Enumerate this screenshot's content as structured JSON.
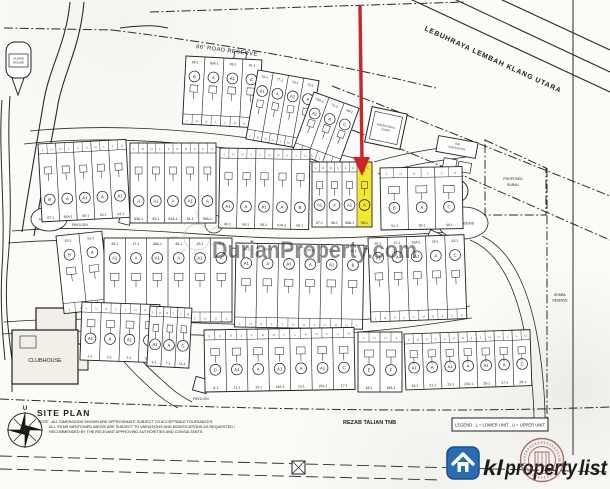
{
  "map": {
    "highway_label": "LEBUHRAYA LEMBAH KLANG UTARA",
    "road_reserve_label": "66' ROAD RESERVE",
    "guard_house_line1": "GUARD",
    "guard_house_line2": "HOUSE",
    "pavilion_label": "PAVILION",
    "playground_label": "PLAYGROUND",
    "par_course_label": "PAR COURSE",
    "basketball_line1": "B.BASKETBALL",
    "basketball_line2": "COURT",
    "tnb_line1": "TNB",
    "tnb_line2": "SUB-STATION",
    "pump_house_label": "PUMP HOUSE",
    "water_tank_line1": "ELEVATED",
    "water_tank_line2": "WATER",
    "water_tank_line3": "TANK",
    "surau_line1": "PROPOSED",
    "surau_line2": "SURAU",
    "bomba_line1": "BOMBA",
    "bomba_line2": "RESERVE",
    "clubhouse_label": "CLUBHOUSE",
    "rezab_label": "REZAB TALIAN TNB",
    "legend_label": "LEGEND : L = LOWER UNIT , U = UPPER UNIT",
    "north_label": "U"
  },
  "titleblock": {
    "title": "SITE PLAN",
    "note1": "NOTE : ALL DIMENSIONS SHOWN ARE APPROXIMATE SUBJECT TO ACCEPTABLE TOLERANCES.",
    "note2": "ALL ITEMS MENTIONED ABOVE ARE SUBJECT TO VARIATIONS AND MODIFICATIONS AS REQUESTED /",
    "note3": "RECOMMENDED BY THE RELEVANT APPROVING AUTHORITIES AND CONSULTANTS."
  },
  "watermark": {
    "text": "DurianProperty.com"
  },
  "logo": {
    "kl": "kl",
    "property": "property",
    "list": "list"
  },
  "highlight": {
    "unit_fill": "#f4e72e",
    "arrow_color": "#c9252b"
  },
  "lot_rows": [
    {
      "id": "r1a",
      "x": 186,
      "y": 56,
      "angle": 3,
      "w": 76,
      "h": 68,
      "n": 4,
      "pos": "top",
      "letters": [
        "B",
        "A",
        "A1",
        "A"
      ],
      "numbers": [
        "85-1",
        "83A-1",
        "83-1",
        "81-1"
      ]
    },
    {
      "id": "r1b",
      "x": 258,
      "y": 70,
      "angle": 10,
      "w": 62,
      "h": 70,
      "n": 4,
      "pos": "top",
      "letters": [
        "A1",
        "A",
        "A1",
        "A"
      ],
      "numbers": [
        "79-1",
        "77-1",
        "75-1",
        "73-1"
      ]
    },
    {
      "id": "r1c",
      "x": 314,
      "y": 92,
      "angle": 20,
      "w": 48,
      "h": 64,
      "n": 3,
      "pos": "top",
      "letters": [
        "A1",
        "A",
        "C"
      ],
      "numbers": [
        "73A-1",
        "71-1",
        "69-1"
      ]
    },
    {
      "id": "r2a",
      "x": 38,
      "y": 144,
      "angle": -3,
      "w": 88,
      "h": 78,
      "n": 5,
      "pos": "bottom",
      "letters": [
        "B",
        "A",
        "A1",
        "A",
        "A1"
      ],
      "numbers": [
        "67-1",
        "65A-1",
        "65-1",
        "63-1",
        "61-1"
      ]
    },
    {
      "id": "r2b",
      "x": 130,
      "y": 143,
      "angle": 0,
      "w": 86,
      "h": 80,
      "n": 5,
      "pos": "bottom",
      "letters": [
        "A",
        "A1",
        "A",
        "A1",
        "A"
      ],
      "numbers": [
        "63A-1",
        "63-1",
        "61A-1",
        "61-1",
        "59A-1"
      ]
    },
    {
      "id": "r2c",
      "x": 220,
      "y": 148,
      "angle": 1,
      "w": 90,
      "h": 80,
      "n": 5,
      "pos": "bottom",
      "letters": [
        "A1",
        "A",
        "A1",
        "A",
        "B"
      ],
      "numbers": [
        "60-1",
        "59-1",
        "58-1",
        "57A-1",
        "56-1"
      ]
    },
    {
      "id": "r2d",
      "x": 312,
      "y": 162,
      "angle": 0,
      "w": 60,
      "h": 65,
      "n": 4,
      "pos": "bottom",
      "letters": [
        "A1",
        "A",
        "A1",
        "A"
      ],
      "numbers": [
        "57-1",
        "56-1",
        "55A-1",
        "55-1"
      ],
      "highlight": 3
    },
    {
      "id": "r2e",
      "x": 380,
      "y": 168,
      "angle": -1,
      "w": 82,
      "h": 62,
      "n": 3,
      "pos": "bottom",
      "letters": [
        "B",
        "A",
        "C"
      ],
      "numbers": [
        "51-1",
        "50-1",
        "49-1"
      ]
    },
    {
      "id": "r3a",
      "x": 56,
      "y": 236,
      "angle": -6,
      "w": 46,
      "h": 78,
      "n": 2,
      "pos": "top",
      "letters": [
        "B",
        "A"
      ],
      "numbers": [
        "53-1",
        "51-1"
      ]
    },
    {
      "id": "r3b",
      "x": 104,
      "y": 238,
      "angle": 0,
      "w": 128,
      "h": 84,
      "n": 6,
      "pos": "top",
      "letters": [
        "A1",
        "A",
        "A1",
        "A",
        "A1",
        "A"
      ],
      "numbers": [
        "49-1",
        "47-1",
        "45A-1",
        "45-1",
        "43-1",
        "41-1"
      ]
    },
    {
      "id": "r3c",
      "x": 236,
      "y": 243,
      "angle": 1,
      "w": 128,
      "h": 84,
      "n": 6,
      "pos": "top",
      "letters": [
        "A1",
        "A",
        "A1",
        "A",
        "A1",
        "B"
      ],
      "numbers": [
        "39-1",
        "37A-1",
        "37-1",
        "35-1",
        "33-1",
        "31-1"
      ]
    },
    {
      "id": "r3d",
      "x": 368,
      "y": 238,
      "angle": -2,
      "w": 96,
      "h": 84,
      "n": 5,
      "pos": "top",
      "letters": [
        "A1",
        "A",
        "A1",
        "A",
        "C"
      ],
      "numbers": [
        "29-1",
        "27-1",
        "25A-1",
        "25-1",
        "23-1"
      ]
    },
    {
      "id": "r4a",
      "x": 82,
      "y": 302,
      "angle": 2,
      "w": 78,
      "h": 58,
      "n": 4,
      "pos": "bottom",
      "letters": [
        "A1",
        "A",
        "A1",
        "A"
      ],
      "numbers": [
        "1-1",
        "2-1",
        "3-1",
        "3A-1"
      ]
    },
    {
      "id": "r4a2",
      "x": 150,
      "y": 306,
      "angle": 3,
      "w": 42,
      "h": 60,
      "n": 3,
      "pos": "bottom",
      "letters": [
        "A1",
        "A",
        "C"
      ],
      "numbers": [
        "5-1",
        "7-1",
        "7A-1"
      ]
    },
    {
      "id": "r4b",
      "x": 204,
      "y": 330,
      "angle": -1,
      "w": 150,
      "h": 62,
      "n": 7,
      "pos": "bottom",
      "letters": [
        "D",
        "A1",
        "A",
        "A1",
        "A",
        "A1",
        "C"
      ],
      "numbers": [
        "9-1",
        "11-1",
        "13-1",
        "13A-1",
        "15-1",
        "15A-1",
        "17-1"
      ]
    },
    {
      "id": "r4c",
      "x": 358,
      "y": 332,
      "angle": 0,
      "w": 44,
      "h": 60,
      "n": 2,
      "pos": "bottom",
      "letters": [
        "E",
        "F"
      ],
      "numbers": [
        "18-1",
        "18A-1"
      ]
    },
    {
      "id": "r4d",
      "x": 404,
      "y": 334,
      "angle": -2,
      "w": 126,
      "h": 56,
      "n": 7,
      "pos": "bottom",
      "letters": [
        "A1",
        "A",
        "A1",
        "A",
        "A1",
        "A",
        "C"
      ],
      "numbers": [
        "19-1",
        "21-1",
        "23-1",
        "23A-1",
        "25-1",
        "27-1",
        "29-1"
      ]
    }
  ]
}
